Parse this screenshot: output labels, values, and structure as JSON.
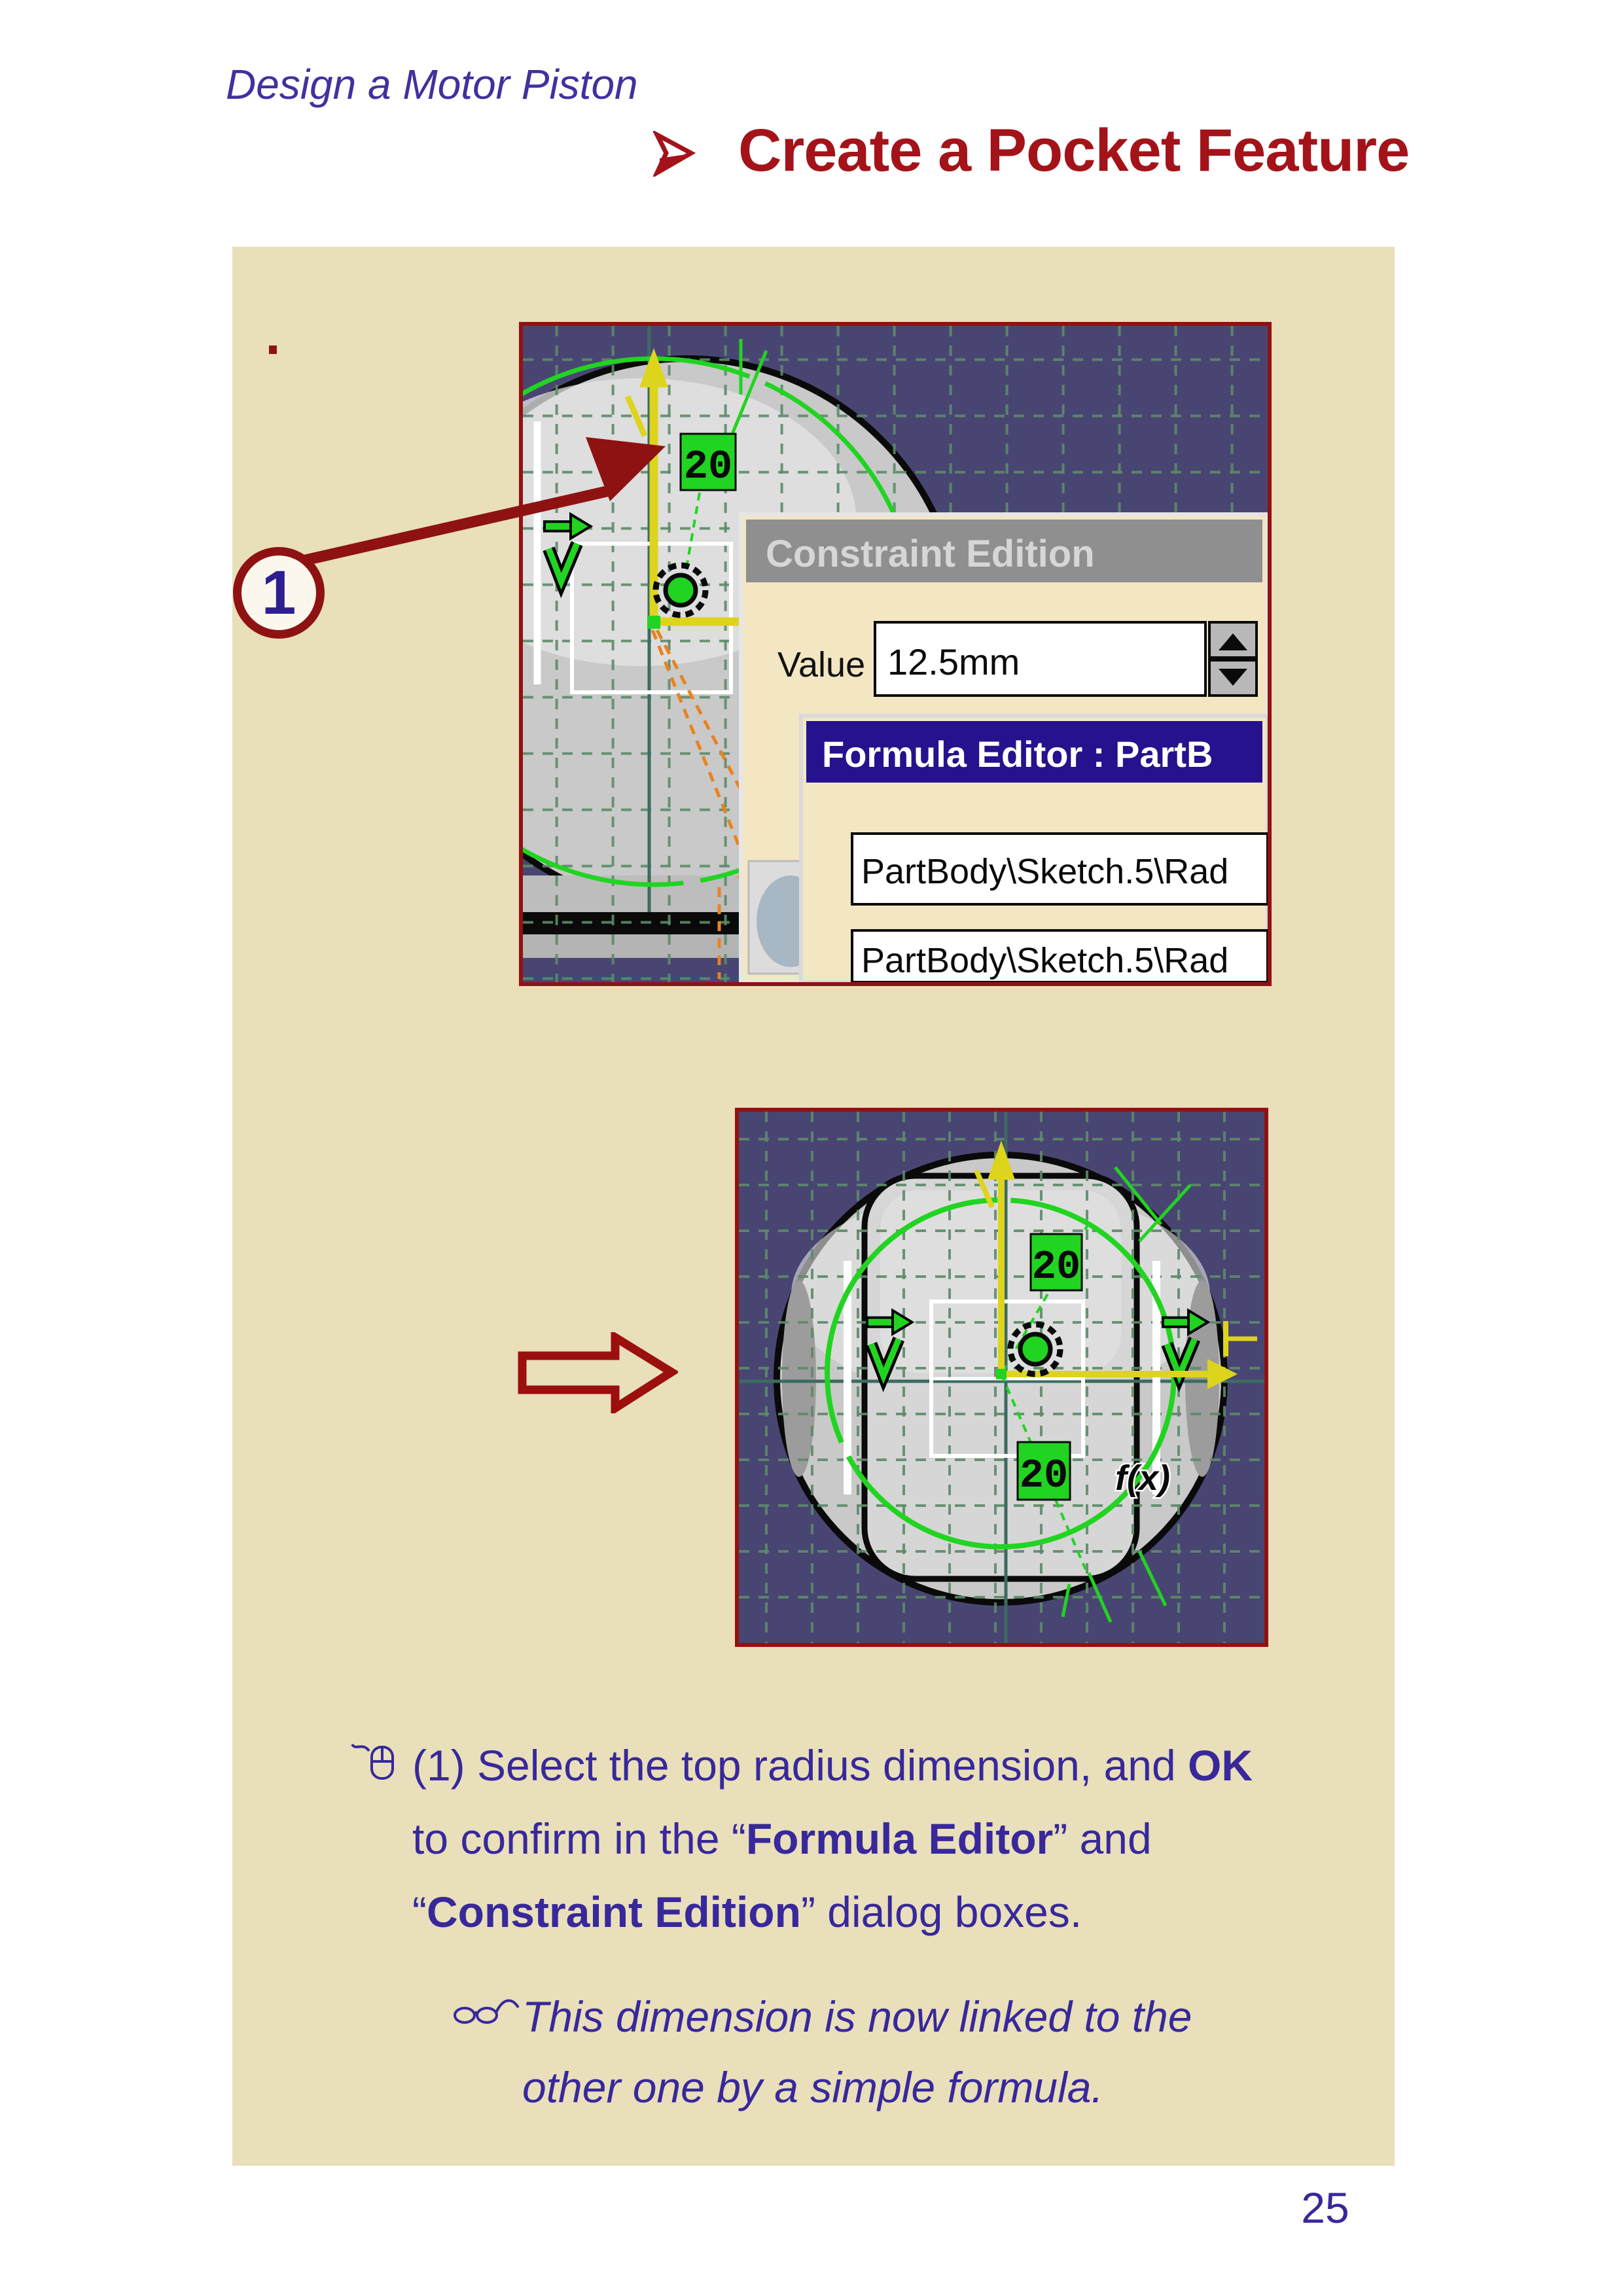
{
  "header": {
    "doc_title": "Design a Motor Piston"
  },
  "title": {
    "text": "Create a Pocket Feature"
  },
  "annotation": {
    "number": "1"
  },
  "screenshot1": {
    "dimension_label": "20",
    "constraint_edition": {
      "title": "Constraint Edition",
      "value_label": "Value",
      "value": "12.5mm"
    },
    "formula_editor": {
      "title": "Formula Editor : PartB",
      "field1": "PartBody\\Sketch.5\\Rad",
      "field2": "PartBody\\Sketch.5\\Rad"
    }
  },
  "screenshot2": {
    "dimension_top": "20",
    "dimension_bottom": "20",
    "fx_label": "f(x)"
  },
  "instructions": {
    "step": {
      "s1": "(1) Select the top radius dimension, and ",
      "b1": "OK",
      "s2": "to confirm in the “",
      "b2": "Formula Editor",
      "s3": "” and",
      "s4": "“",
      "b3": "Constraint Edition",
      "s5": "” dialog boxes."
    },
    "note": {
      "line1": "This dimension is now linked to the",
      "line2": "other one by a simple formula."
    }
  },
  "page_number": "25",
  "colors": {
    "accent_red": "#9a1115",
    "text_purple": "#38289b",
    "panel_beige": "#e9dfba",
    "cad_background": "#494573",
    "dialog_beige": "#f3e6c3",
    "constraint_green": "#21d421",
    "dimension_yellow": "#ddd41c",
    "formula_title_navy": "#26128e"
  }
}
